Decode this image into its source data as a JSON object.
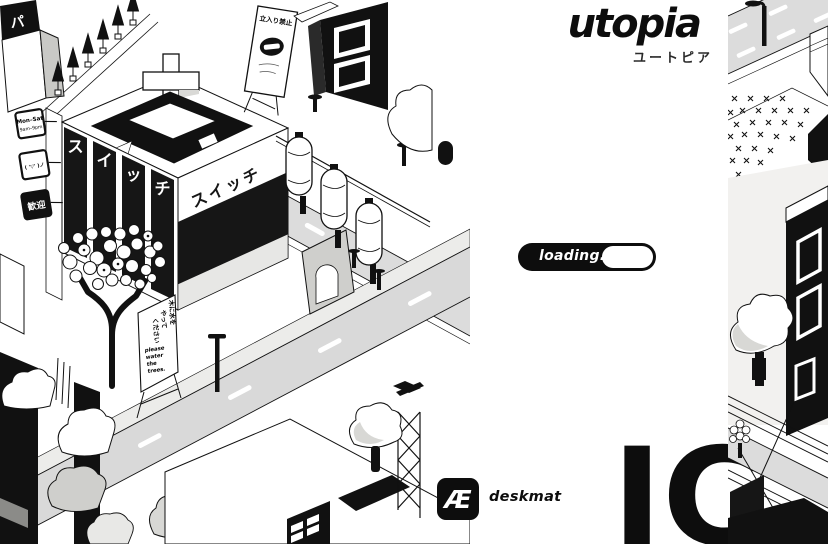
{
  "header": {
    "title": "utopia",
    "subtitle_jp": "ユートピア"
  },
  "loader": {
    "label": "loading.",
    "progress_fraction": 0.62
  },
  "brand": {
    "logo_glyph": "Æ",
    "name": "deskmat"
  },
  "watermark": {
    "letters": "IC"
  },
  "colors": {
    "ink": "#111111",
    "road_gray": "#dcdcdc",
    "panel_black": "#161616",
    "light_gray": "#f2f1ef",
    "bush_gray": "#d8d8d5"
  },
  "city": {
    "switch_sign_vertical": [
      "ス",
      "イ",
      "ッ",
      "チ"
    ],
    "switch_sign_side": "スイッチ",
    "no_entry_sign": "立入り禁止",
    "hours_sign": {
      "line1": "Mon–Sat",
      "line2": "9am–9pm"
    },
    "kaomoji_sign": "( '▽' )ノ",
    "welcome_sign": "歓迎",
    "corner_sign": "パ",
    "water_sign": {
      "jp_col1": "木に水を",
      "jp_col2": "やって",
      "jp_col3": "ください",
      "en_lines": [
        "please",
        "water",
        "the",
        "trees."
      ]
    }
  }
}
